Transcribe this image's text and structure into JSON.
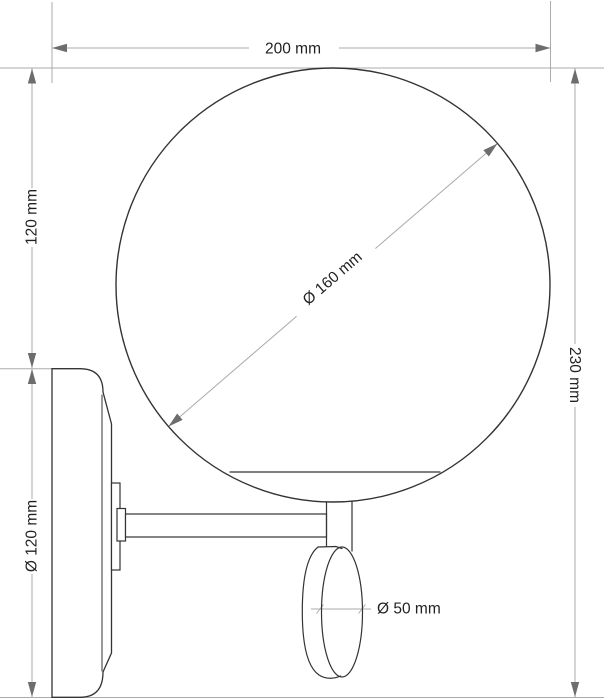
{
  "drawing": {
    "dimensions": {
      "overall_width": "200 mm",
      "globe_top_to_backplate": "120 mm",
      "backplate_diameter": "Ø 120 mm",
      "overall_height": "230 mm",
      "globe_diameter": "Ø 160 mm",
      "bulb_diameter": "Ø 50 mm"
    },
    "colors": {
      "background": "#ffffff",
      "object_line": "#333333",
      "dimension_line": "#ababab",
      "arrow": "#6d6d6d",
      "text": "#222222"
    }
  }
}
